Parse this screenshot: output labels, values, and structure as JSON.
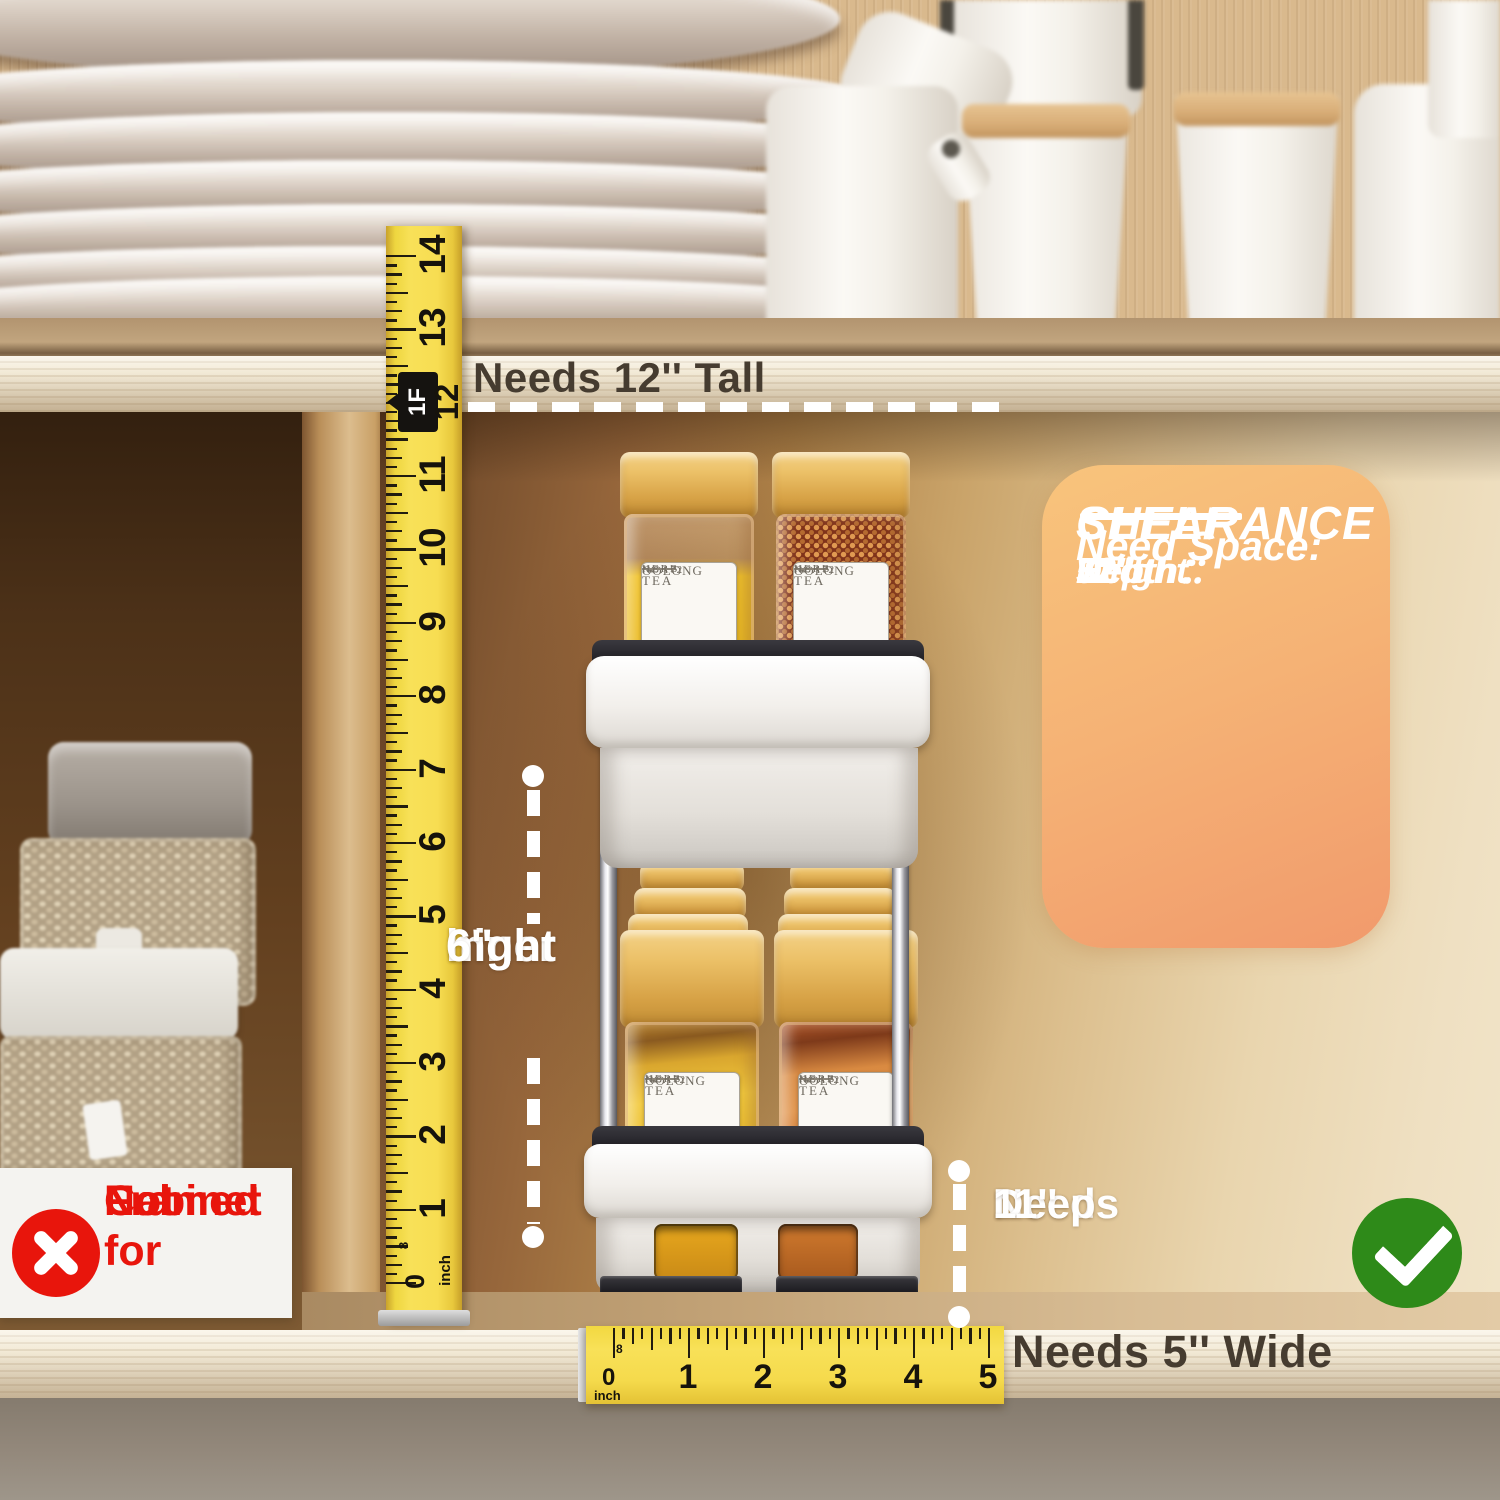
{
  "annotations": {
    "needs_tall": "Needs 12'' Tall",
    "inner_height_lines": [
      "inner",
      "hight",
      "6''"
    ],
    "needs_deep_lines": [
      "Needs",
      "Deep",
      "11''"
    ],
    "needs_wide": "Needs 5'' Wide",
    "not_for_lines": [
      "Not for",
      "Framed",
      "Cabinet"
    ]
  },
  "clearance_card": {
    "title_lines": [
      "SHELF",
      "CLEARANCE"
    ],
    "subtitle": "Need Space:",
    "specs": [
      {
        "label": "Height：",
        "value": "12''"
      },
      {
        "label": "Depth：",
        "value": "11''"
      },
      {
        "label": "Width：",
        "value": "5''"
      }
    ]
  },
  "vertical_ruler": {
    "unit_label": "inch",
    "zero_label": "0",
    "eighth_label": "8",
    "foot_marker": "1F",
    "foot_inches": "12",
    "numbers": [
      "1",
      "2",
      "3",
      "4",
      "5",
      "6",
      "7",
      "8",
      "9",
      "10",
      "11",
      "13",
      "14"
    ]
  },
  "horizontal_ruler": {
    "unit_label": "inch",
    "zero_label": "0",
    "eighth_label": "8",
    "numbers": [
      "1",
      "2",
      "3",
      "4",
      "5"
    ]
  },
  "spice_label": {
    "no": "NO.172",
    "line1": "TEA",
    "line2": "OOLONG",
    "line3": "HERB"
  },
  "colors": {
    "tape_yellow": "#f3d64b",
    "card_gradient_from": "#f8c47c",
    "card_gradient_to": "#f19a6c",
    "alert_red": "#e8150c",
    "ok_green": "#2e8a19",
    "annotation_dark": "#463c30"
  }
}
